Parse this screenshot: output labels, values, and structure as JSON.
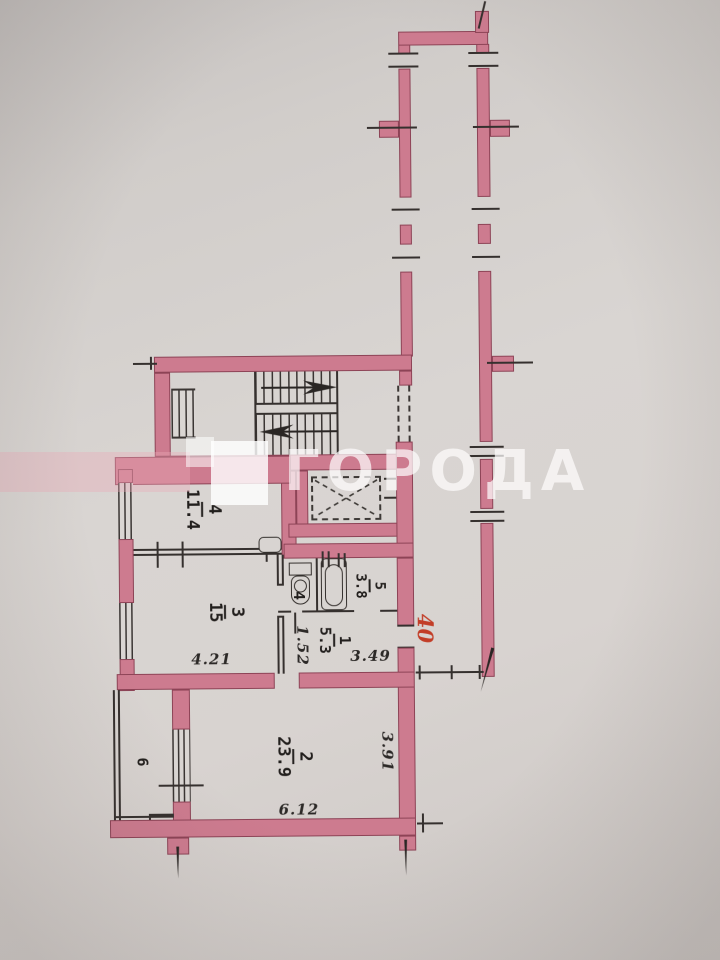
{
  "plan": {
    "watermark": {
      "text": "ГОРОДА"
    },
    "apartment_number": "40",
    "rooms": [
      {
        "name": "room-4",
        "num": "4",
        "area": "11.4"
      },
      {
        "name": "room-3",
        "num": "3",
        "area": "15"
      },
      {
        "name": "wc",
        "num": "4",
        "area": ""
      },
      {
        "name": "bathroom",
        "num": "5",
        "area": "3.8"
      },
      {
        "name": "hall",
        "num": "1",
        "area": "5.3"
      },
      {
        "name": "room-2",
        "num": "2",
        "area": "23.9"
      },
      {
        "name": "balcony",
        "num": "6",
        "area": ""
      }
    ],
    "dimensions": {
      "room3_width": "4.21",
      "hall_depth": "1.52",
      "hall_width": "3.49",
      "room2_depth": "3.91",
      "room2_width": "6.12"
    }
  }
}
